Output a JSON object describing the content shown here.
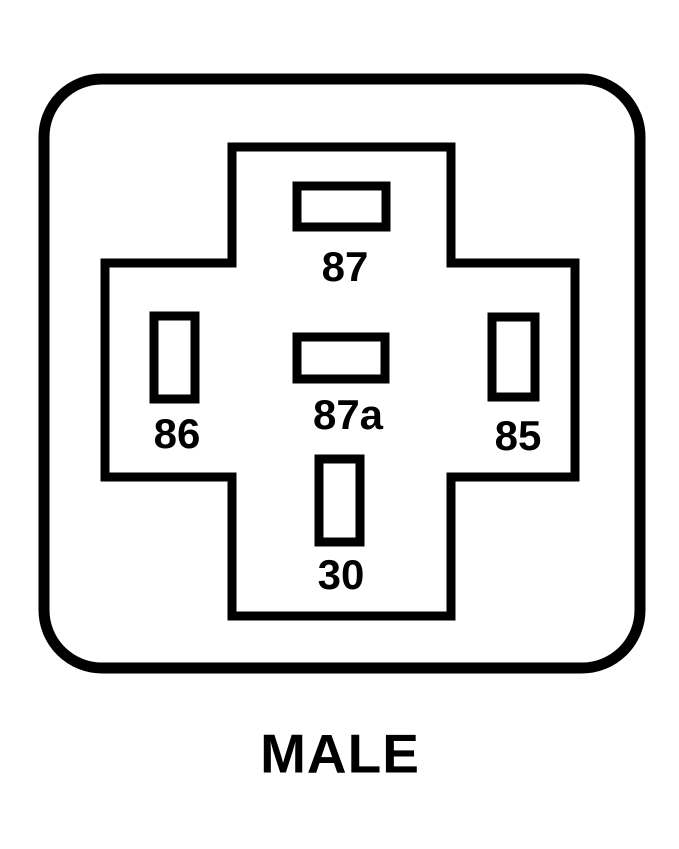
{
  "diagram": {
    "caption": "MALE",
    "colors": {
      "line": "#000000",
      "background": "#ffffff"
    },
    "pins": [
      {
        "label": "87",
        "position": "top",
        "slot_orientation": "horizontal"
      },
      {
        "label": "87a",
        "position": "center",
        "slot_orientation": "horizontal"
      },
      {
        "label": "86",
        "position": "left",
        "slot_orientation": "vertical"
      },
      {
        "label": "85",
        "position": "right",
        "slot_orientation": "vertical"
      },
      {
        "label": "30",
        "position": "bottom",
        "slot_orientation": "vertical"
      }
    ]
  }
}
